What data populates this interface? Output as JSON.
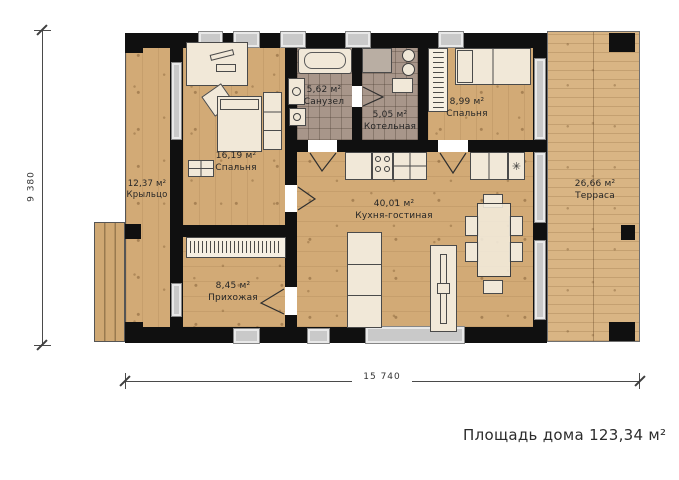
{
  "rooms": [
    {
      "area": "12,37 м²",
      "name": "Крыльцо"
    },
    {
      "area": "16,19 м²",
      "name": "Спальня"
    },
    {
      "area": "5,62 м²",
      "name": "Санузел"
    },
    {
      "area": "5,05 м²",
      "name": "Котельная"
    },
    {
      "area": "8,99 м²",
      "name": "Спальня"
    },
    {
      "area": "40,01 м²",
      "name": "Кухня-гостиная"
    },
    {
      "area": "8,45 м²",
      "name": "Прихожая"
    },
    {
      "area": "26,66 м²",
      "name": "Терраса"
    }
  ],
  "dimensions": {
    "bottom_total": "15 740",
    "left_total": "9 380"
  },
  "summary": {
    "total_area_label": "Площадь дома 123,34 м²"
  },
  "icons": {
    "fridge": "✳"
  },
  "colors": {
    "wall": "#101010",
    "wood_floor": "#d2aa76",
    "deck": "#d9b584",
    "tile": "#a8968a",
    "window": "#c9c9c9",
    "furniture": "#f1e8d8"
  }
}
